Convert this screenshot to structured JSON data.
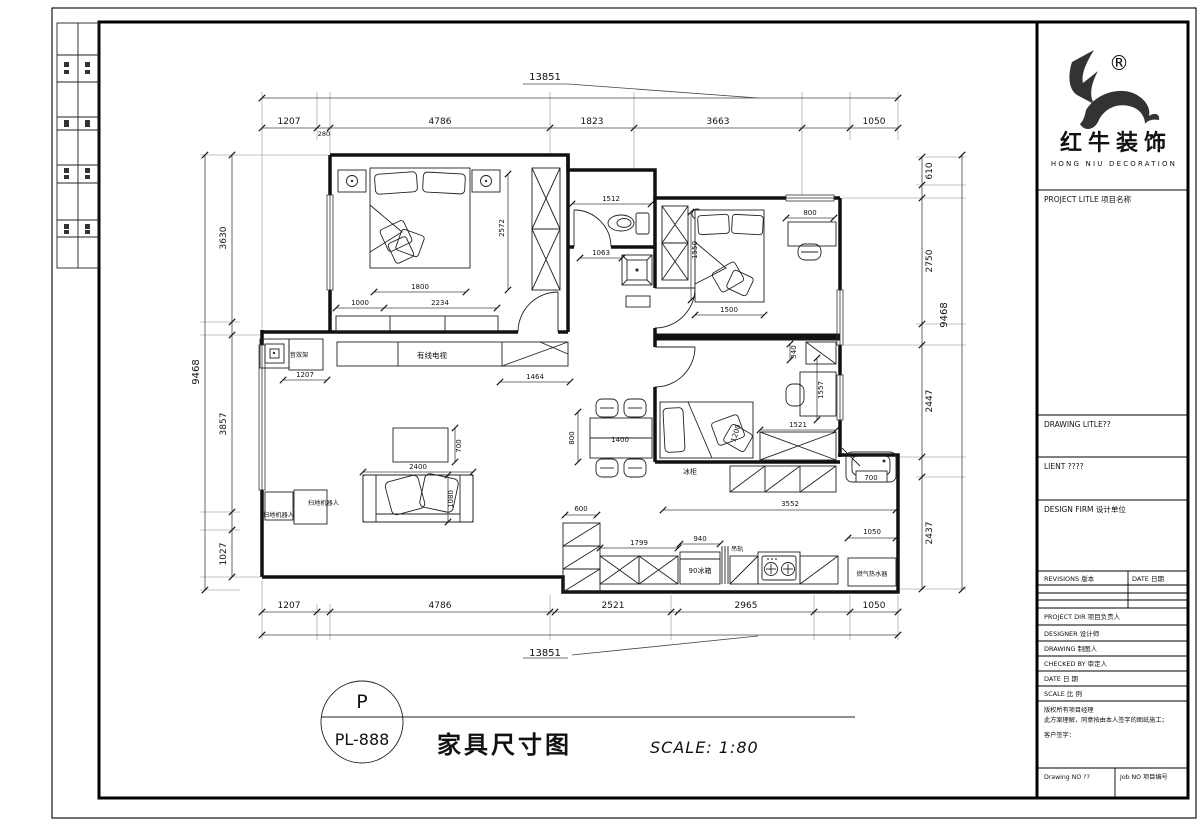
{
  "footer": {
    "bubble_top": "P",
    "bubble_bottom": "PL-888",
    "title": "家具尺寸图",
    "scale": "SCALE: 1:80"
  },
  "title_block": {
    "registered": "®",
    "brand_cn": "红牛装饰",
    "brand_en": "HONG NIU DECORATION",
    "project_title_label": "PROJECT LITLE  项目名称",
    "drawing_title_label": "DRAWING LITLE??",
    "client_label": "LIENT ????",
    "design_firm_label": "DESIGN FIRM 设计单位",
    "revisions_label": "REVISIONS 版本",
    "date_col_label": "DATE 日期",
    "project_dir_label": "PROJECT DIR   项目负责人",
    "designer_label": "DESIGNER   设计师",
    "drawing_label": "DRAWING   制图人",
    "checked_by_label": "CHECKED BY   审定人",
    "date_label": "DATE   日 期",
    "scale_label": "SCALE   比 例",
    "copyright_1": "版权所有项目经理",
    "copyright_2": "此方案理解，同意按由本人签字的图纸施工；",
    "copyright_3": "客户签字：",
    "drawing_no_label": "Drawing NO ??",
    "job_no_label": "Job NO 项目编号"
  },
  "plan": {
    "dims": {
      "top_total": "13851",
      "top_1": "1207",
      "top_1b": "280",
      "top_2": "4786",
      "top_3": "1823",
      "top_4": "3663",
      "top_5": "1050",
      "left_total": "9468",
      "left_1": "3630",
      "left_2": "3857",
      "left_3": "1027",
      "right_1": "610",
      "right_2": "2750",
      "right_total": "9468",
      "right_3": "2447",
      "right_4": "2437",
      "bottom_1": "1207",
      "bottom_2": "4786",
      "bottom_3": "2521",
      "bottom_4": "2965",
      "bottom_5": "1050",
      "bottom_total": "13851",
      "bed1_height": "2572",
      "bed1_width": "1800",
      "bed1_a": "1000",
      "bed1_b": "2234",
      "bath_width": "1512",
      "shower": "1063",
      "bed2_height": "1550",
      "bed2_desk": "800",
      "bed2_width": "1500",
      "study_a": "340",
      "study_b": "1557",
      "study_c": "1521",
      "study_bed": "1200",
      "shelf": "1207",
      "tv": "1464",
      "table_w": "2400",
      "table_d": "700",
      "sofa_d": "1080",
      "dining_d": "800",
      "dining_w": "1400",
      "k_600": "600",
      "k_1799": "1799",
      "k_940": "940",
      "k_3552": "3552",
      "k_1050": "1050",
      "sink": "700"
    },
    "labels": {
      "tv": "有线电视",
      "shelf": "音效架",
      "vacuum_a": "扫地机器人",
      "vacuum_b": "扫地机器人",
      "freezer": "冰柜",
      "rail": "吊轨",
      "fridge": "90冰箱",
      "heater": "燃气热水器"
    }
  }
}
